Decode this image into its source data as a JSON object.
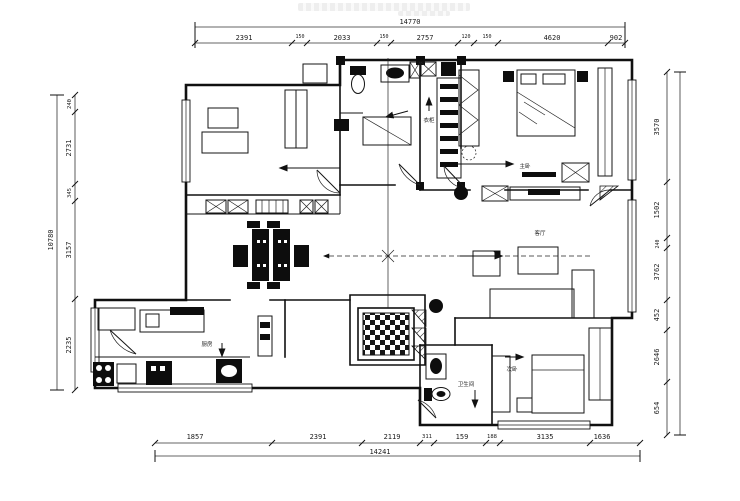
{
  "drawing": {
    "type": "apartment-floor-plan",
    "line_color": "#101010",
    "background": "#ffffff"
  },
  "dimensions": {
    "top": {
      "total": "14770",
      "segments": [
        "2391",
        "150",
        "2033",
        "150",
        "2757",
        "120",
        "150",
        "4620",
        "902"
      ]
    },
    "bottom": {
      "total": "14241",
      "segments": [
        "1857",
        "2391",
        "2119",
        "311",
        "159",
        "188",
        "3135",
        "1636"
      ]
    },
    "left": {
      "total": "10780",
      "segments": [
        "240",
        "2731",
        "345",
        "3157",
        "2235"
      ]
    },
    "right": {
      "segments": [
        "3570",
        "1502",
        "240",
        "3762",
        "452",
        "2646",
        "654"
      ]
    }
  },
  "room_labels": {
    "master_bedroom": "主卧",
    "living_room": "客厅",
    "kitchen": "厨房",
    "bathroom": "卫生间",
    "second_bedroom": "次卧",
    "closet": "衣柜"
  }
}
